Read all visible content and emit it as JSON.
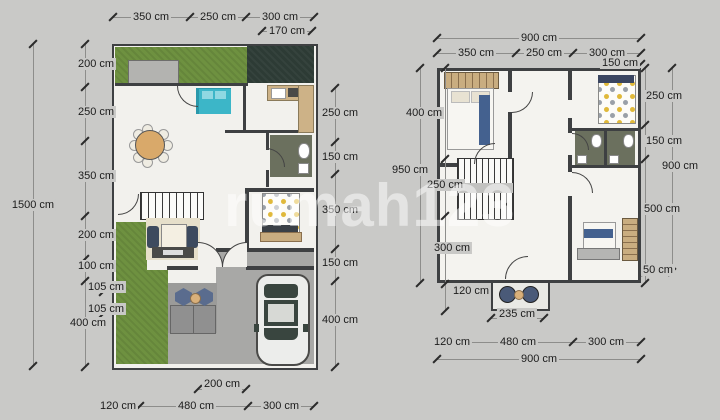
{
  "watermark": "rumah123",
  "palette": {
    "background": "#c9c9c7",
    "wall": "#3e4042",
    "floor": "#f2f1ed",
    "grass": "#6e9140",
    "dark_garden": "#2d3b35",
    "pavement": "#a8a8a6",
    "accent_teal": "#3cb6c8",
    "accent_yellow": "#e0b93a",
    "accent_blue": "#44618f",
    "wood": "#c9ad80",
    "bath_floor": "#6b705e"
  },
  "icons": {
    "bed": "css-rect-shape",
    "dining_table": "css-circle-shape",
    "sofa_set": "css-rect-shapes",
    "stairs": "hatched-rect",
    "car": "css-rounded-rect",
    "toilet": "white-oval",
    "wardrobe": "striped-rect",
    "patio_chair": "hexagon",
    "planter": "gray-rect"
  },
  "floor1": {
    "top_dims": [
      "350 cm",
      "250 cm",
      "300 cm"
    ],
    "top_sub_dim": "170 cm",
    "left_total_dim": "1500 cm",
    "left_dims": [
      "200 cm",
      "250 cm",
      "350 cm",
      "200 cm",
      "100 cm",
      "105 cm",
      "105 cm",
      "400 cm"
    ],
    "right_dims": [
      "250 cm",
      "150 cm",
      "350 cm",
      "150 cm",
      "400 cm"
    ],
    "bottom_sub_dim": "200 cm",
    "bottom_dims": [
      "120 cm",
      "480 cm",
      "300 cm"
    ]
  },
  "floor2": {
    "top_total_dim": "900 cm",
    "top_dims": [
      "350 cm",
      "250 cm",
      "300 cm"
    ],
    "top_sub_dim": "150 cm",
    "left_total_dim": "950 cm",
    "left_dims": [
      "400 cm",
      "250 cm",
      "300 cm",
      "120 cm"
    ],
    "right_total_dim": "900 cm",
    "right_dims": [
      "250 cm",
      "150 cm",
      "500 cm",
      "50 cm"
    ],
    "bottom_sub_dim": "235 cm",
    "bottom_dims": [
      "120 cm",
      "480 cm",
      "300 cm"
    ],
    "bottom_total_dim": "900 cm"
  }
}
